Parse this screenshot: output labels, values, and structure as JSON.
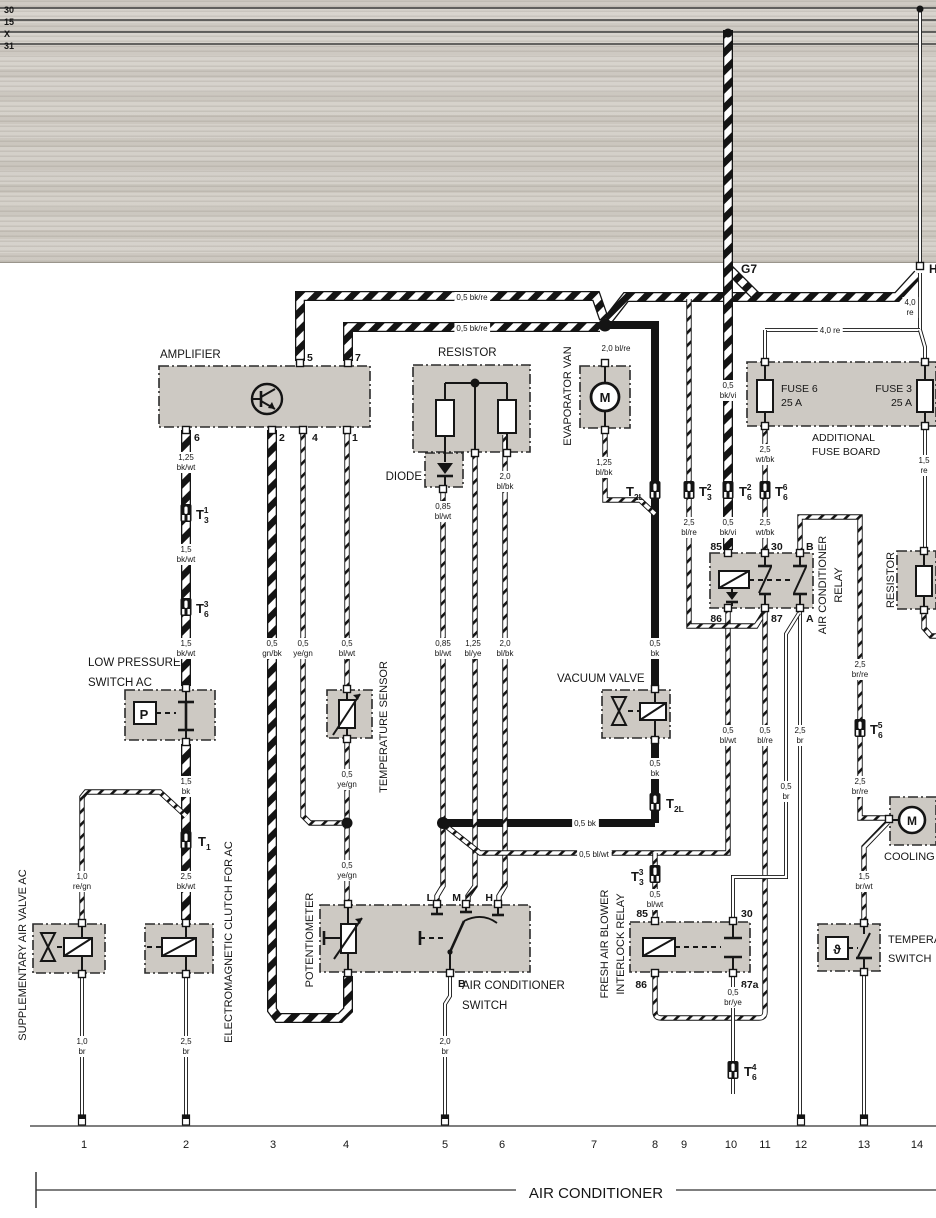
{
  "colors": {
    "ink": "#161616",
    "box_fill": "#cdc9c3",
    "scan_band": "#d6d2cb",
    "paper": "#ffffff"
  },
  "texts": {
    "bus_labels": [
      {
        "name": "bus-label-30",
        "text": "30",
        "x": 4,
        "y": 13,
        "size": 9,
        "bold": true,
        "anchor": "start"
      },
      {
        "name": "bus-label-15",
        "text": "15",
        "x": 4,
        "y": 25,
        "size": 9,
        "bold": true,
        "anchor": "start"
      },
      {
        "name": "bus-label-x",
        "text": "X",
        "x": 4,
        "y": 37,
        "size": 9,
        "bold": true,
        "anchor": "start"
      },
      {
        "name": "bus-label-31",
        "text": "31",
        "x": 4,
        "y": 49,
        "size": 9,
        "bold": true,
        "anchor": "start"
      }
    ],
    "node_labels": [
      {
        "name": "node-g7",
        "text": "G7",
        "x": 741,
        "y": 273,
        "size": 12,
        "bold": true,
        "anchor": "start"
      },
      {
        "name": "node-h",
        "text": "H",
        "x": 929,
        "y": 273,
        "size": 12,
        "bold": true,
        "anchor": "start"
      }
    ],
    "component_labels": [
      {
        "name": "label-amplifier",
        "text": "AMPLIFIER",
        "x": 160,
        "y": 358,
        "size": 11.5,
        "anchor": "start"
      },
      {
        "name": "label-resistor",
        "text": "RESISTOR",
        "x": 438,
        "y": 356,
        "size": 11.5,
        "anchor": "start"
      },
      {
        "name": "label-diode",
        "text": "DIODE",
        "x": 422,
        "y": 480,
        "size": 11.5,
        "anchor": "end"
      },
      {
        "name": "label-evaporator-van",
        "text": "EVAPORATOR VAN",
        "x": 571,
        "y": 396,
        "size": 11,
        "rot": -90
      },
      {
        "name": "label-fuse6",
        "text": "FUSE 6",
        "x": 781,
        "y": 392,
        "size": 10.5,
        "anchor": "start"
      },
      {
        "name": "label-fuse6-amps",
        "text": "25 A",
        "x": 781,
        "y": 406,
        "size": 10.5,
        "anchor": "start"
      },
      {
        "name": "label-fuse3",
        "text": "FUSE 3",
        "x": 912,
        "y": 392,
        "size": 10.5,
        "anchor": "end"
      },
      {
        "name": "label-fuse3-amps",
        "text": "25 A",
        "x": 912,
        "y": 406,
        "size": 10.5,
        "anchor": "end"
      },
      {
        "name": "label-additional",
        "text": "ADDITIONAL",
        "x": 812,
        "y": 441,
        "size": 10.5,
        "anchor": "start"
      },
      {
        "name": "label-fuse-board",
        "text": "FUSE BOARD",
        "x": 812,
        "y": 455,
        "size": 10.5,
        "anchor": "start"
      },
      {
        "name": "label-ac-relay-1",
        "text": "AIR CONDITIONER",
        "x": 826,
        "y": 585,
        "size": 11,
        "rot": -90
      },
      {
        "name": "label-ac-relay-2",
        "text": "RELAY",
        "x": 842,
        "y": 585,
        "size": 11,
        "rot": -90
      },
      {
        "name": "label-resistor-right",
        "text": "RESISTOR",
        "x": 894,
        "y": 580,
        "size": 11,
        "rot": -90
      },
      {
        "name": "label-low-pressure-1",
        "text": "LOW PRESSURE",
        "x": 88,
        "y": 666,
        "size": 11.5,
        "anchor": "start"
      },
      {
        "name": "label-low-pressure-2",
        "text": "SWITCH AC",
        "x": 88,
        "y": 686,
        "size": 11.5,
        "anchor": "start"
      },
      {
        "name": "label-temp-sensor",
        "text": "TEMPERATURE SENSOR",
        "x": 387,
        "y": 727,
        "size": 11,
        "rot": -90
      },
      {
        "name": "label-vacuum-valve",
        "text": "VACUUM VALVE",
        "x": 557,
        "y": 682,
        "size": 11.5,
        "anchor": "start"
      },
      {
        "name": "label-supp-air-valve",
        "text": "SUPPLEMENTARY AIR VALVE AC",
        "x": 26,
        "y": 955,
        "size": 11,
        "rot": -90
      },
      {
        "name": "label-clutch",
        "text": "ELECTROMAGNETIC CLUTCH FOR AC",
        "x": 232,
        "y": 942,
        "size": 11,
        "rot": -90
      },
      {
        "name": "label-potentiometer",
        "text": "POTENTIOMETER",
        "x": 313,
        "y": 940,
        "size": 11,
        "rot": -90
      },
      {
        "name": "label-ac-switch-1",
        "text": "AIR CONDITIONER",
        "x": 462,
        "y": 989,
        "size": 11.5,
        "anchor": "start"
      },
      {
        "name": "label-ac-switch-2",
        "text": "SWITCH",
        "x": 462,
        "y": 1009,
        "size": 11.5,
        "anchor": "start"
      },
      {
        "name": "label-fresh-air-1",
        "text": "FRESH AIR BLOWER",
        "x": 608,
        "y": 944,
        "size": 11,
        "rot": -90
      },
      {
        "name": "label-fresh-air-2",
        "text": "INTERLOCK RELAY",
        "x": 624,
        "y": 944,
        "size": 11,
        "rot": -90
      },
      {
        "name": "label-cooling-fan",
        "text": "COOLING FAN",
        "x": 884,
        "y": 860,
        "size": 11,
        "anchor": "start"
      },
      {
        "name": "label-temp-switch-1",
        "text": "TEMPERATURE",
        "x": 888,
        "y": 943,
        "size": 11,
        "anchor": "start"
      },
      {
        "name": "label-temp-switch-2",
        "text": "SWITCH",
        "x": 888,
        "y": 962,
        "size": 11,
        "anchor": "start"
      }
    ],
    "terminal_labels": [
      {
        "text": "5",
        "x": 307,
        "y": 361,
        "size": 10.5,
        "bold": true,
        "anchor": "start"
      },
      {
        "text": "7",
        "x": 355,
        "y": 361,
        "size": 10.5,
        "bold": true,
        "anchor": "start"
      },
      {
        "text": "6",
        "x": 194,
        "y": 441,
        "size": 10.5,
        "bold": true,
        "anchor": "start"
      },
      {
        "text": "2",
        "x": 279,
        "y": 441,
        "size": 10.5,
        "bold": true,
        "anchor": "start"
      },
      {
        "text": "4",
        "x": 312,
        "y": 441,
        "size": 10.5,
        "bold": true,
        "anchor": "start"
      },
      {
        "text": "1",
        "x": 352,
        "y": 441,
        "size": 10.5,
        "bold": true,
        "anchor": "start"
      },
      {
        "text": "85",
        "x": 722,
        "y": 550,
        "size": 10.5,
        "bold": true,
        "anchor": "end"
      },
      {
        "text": "30",
        "x": 771,
        "y": 550,
        "size": 10.5,
        "bold": true,
        "anchor": "start"
      },
      {
        "text": "B",
        "x": 806,
        "y": 550,
        "size": 10.5,
        "bold": true,
        "anchor": "start"
      },
      {
        "text": "86",
        "x": 722,
        "y": 622,
        "size": 10.5,
        "bold": true,
        "anchor": "end"
      },
      {
        "text": "87",
        "x": 771,
        "y": 622,
        "size": 10.5,
        "bold": true,
        "anchor": "start"
      },
      {
        "text": "A",
        "x": 806,
        "y": 622,
        "size": 10.5,
        "bold": true,
        "anchor": "start"
      },
      {
        "text": "L",
        "x": 433,
        "y": 901,
        "size": 10.5,
        "bold": true,
        "anchor": "end"
      },
      {
        "text": "M",
        "x": 461,
        "y": 901,
        "size": 10.5,
        "bold": true,
        "anchor": "end"
      },
      {
        "text": "H",
        "x": 493,
        "y": 901,
        "size": 10.5,
        "bold": true,
        "anchor": "end"
      },
      {
        "text": "B",
        "x": 458,
        "y": 987,
        "size": 10.5,
        "bold": true,
        "anchor": "start"
      },
      {
        "text": "85",
        "x": 648,
        "y": 917,
        "size": 10.5,
        "bold": true,
        "anchor": "end"
      },
      {
        "text": "30",
        "x": 741,
        "y": 917,
        "size": 10.5,
        "bold": true,
        "anchor": "start"
      },
      {
        "text": "86",
        "x": 647,
        "y": 988,
        "size": 10.5,
        "bold": true,
        "anchor": "end"
      },
      {
        "text": "87a",
        "x": 741,
        "y": 988,
        "size": 10.5,
        "bold": true,
        "anchor": "start"
      }
    ],
    "connector_labels": [
      {
        "name": "conn-t3-1",
        "main": "T",
        "sub": "3",
        "sup": "1",
        "x": 196,
        "y": 519,
        "anchor": "start"
      },
      {
        "name": "conn-t6-3",
        "main": "T",
        "sub": "6",
        "sup": "3",
        "x": 196,
        "y": 613,
        "anchor": "start"
      },
      {
        "name": "conn-t1",
        "main": "T",
        "sub": "1",
        "x": 198,
        "y": 846,
        "anchor": "start"
      },
      {
        "name": "conn-t2l-upper",
        "main": "T",
        "sub": "2L",
        "x": 626,
        "y": 496,
        "anchor": "start"
      },
      {
        "name": "conn-t3-2",
        "main": "T",
        "sub": "3",
        "sup": "2",
        "x": 699,
        "y": 496,
        "anchor": "start"
      },
      {
        "name": "conn-t6-2",
        "main": "T",
        "sub": "6",
        "sup": "2",
        "x": 739,
        "y": 496,
        "anchor": "start"
      },
      {
        "name": "conn-t6-6",
        "main": "T",
        "sub": "6",
        "sup": "6",
        "x": 775,
        "y": 496,
        "anchor": "start"
      },
      {
        "name": "conn-t2l-lower",
        "main": "T",
        "sub": "2L",
        "x": 666,
        "y": 808,
        "anchor": "start"
      },
      {
        "name": "conn-t6-5",
        "main": "T",
        "sub": "6",
        "sup": "5",
        "x": 870,
        "y": 734,
        "anchor": "start"
      },
      {
        "name": "conn-t3-3",
        "main": "T",
        "sub": "3",
        "sup": "3",
        "x": 631,
        "y": 881,
        "anchor": "start"
      },
      {
        "name": "conn-t6-4",
        "main": "T",
        "sub": "6",
        "sup": "4",
        "x": 744,
        "y": 1076,
        "anchor": "start"
      }
    ],
    "wire_labels": [
      {
        "lines": [
          "0,5  bk/re"
        ],
        "x": 472,
        "y": 300,
        "bg": true
      },
      {
        "lines": [
          "0,5  bk/re"
        ],
        "x": 472,
        "y": 331,
        "bg": true
      },
      {
        "lines": [
          "2,0  bl/re"
        ],
        "x": 616,
        "y": 351,
        "bg": true
      },
      {
        "lines": [
          "4,0",
          "re"
        ],
        "x": 910,
        "y": 305,
        "bg": true
      },
      {
        "lines": [
          "4,0  re"
        ],
        "x": 830,
        "y": 333,
        "bg": true
      },
      {
        "lines": [
          "1,25",
          "bl/bk"
        ],
        "x": 604,
        "y": 465,
        "bg": true
      },
      {
        "lines": [
          "0,85",
          "bl/wt"
        ],
        "x": 443,
        "y": 509,
        "bg": true
      },
      {
        "lines": [
          "2,0",
          "bl/bk"
        ],
        "x": 505,
        "y": 479,
        "bg": true
      },
      {
        "lines": [
          "1,25",
          "bk/wt"
        ],
        "x": 186,
        "y": 460,
        "bg": true
      },
      {
        "lines": [
          "1,5",
          "bk/wt"
        ],
        "x": 186,
        "y": 552,
        "bg": true
      },
      {
        "lines": [
          "1,5",
          "bk/wt"
        ],
        "x": 186,
        "y": 646,
        "bg": true
      },
      {
        "lines": [
          "0,5",
          "gn/bk"
        ],
        "x": 272,
        "y": 646,
        "bg": true
      },
      {
        "lines": [
          "0,5",
          "ye/gn"
        ],
        "x": 303,
        "y": 646,
        "bg": true
      },
      {
        "lines": [
          "0,5",
          "bl/wt"
        ],
        "x": 347,
        "y": 646,
        "bg": true
      },
      {
        "lines": [
          "0,85",
          "bl/wt"
        ],
        "x": 443,
        "y": 646,
        "bg": true
      },
      {
        "lines": [
          "1,25",
          "bl/ye"
        ],
        "x": 473,
        "y": 646,
        "bg": true
      },
      {
        "lines": [
          "2,0",
          "bl/bk"
        ],
        "x": 505,
        "y": 646,
        "bg": true
      },
      {
        "lines": [
          "0,5",
          "bk"
        ],
        "x": 655,
        "y": 646,
        "bg": true
      },
      {
        "lines": [
          "0,5",
          "ye/gn"
        ],
        "x": 347,
        "y": 777,
        "bg": true
      },
      {
        "lines": [
          "1,5",
          "bk"
        ],
        "x": 186,
        "y": 784,
        "bg": true
      },
      {
        "lines": [
          "0,5",
          "bk"
        ],
        "x": 655,
        "y": 766,
        "bg": true
      },
      {
        "lines": [
          "1,0",
          "re/gn"
        ],
        "x": 82,
        "y": 879,
        "bg": true
      },
      {
        "lines": [
          "2,5",
          "bk/wt"
        ],
        "x": 186,
        "y": 879,
        "bg": true
      },
      {
        "lines": [
          "0,5",
          "ye/gn"
        ],
        "x": 347,
        "y": 868,
        "bg": true
      },
      {
        "lines": [
          "0,5 bk"
        ],
        "x": 585,
        "y": 826,
        "bg": true
      },
      {
        "lines": [
          "0,5 bl/wt"
        ],
        "x": 594,
        "y": 857,
        "bg": true
      },
      {
        "lines": [
          "0,5",
          "bl/wt"
        ],
        "x": 655,
        "y": 897,
        "bg": true
      },
      {
        "lines": [
          "0,5",
          "bk/vi"
        ],
        "x": 728,
        "y": 388,
        "bg": true
      },
      {
        "lines": [
          "2,5",
          "wt/bk"
        ],
        "x": 765,
        "y": 452,
        "bg": true
      },
      {
        "lines": [
          "0,5",
          "bk/vi"
        ],
        "x": 728,
        "y": 525,
        "bg": true
      },
      {
        "lines": [
          "2,5",
          "wt/bk"
        ],
        "x": 765,
        "y": 525,
        "bg": true
      },
      {
        "lines": [
          "2,5",
          "bl/re"
        ],
        "x": 689,
        "y": 525,
        "bg": true
      },
      {
        "lines": [
          "1,5",
          "re"
        ],
        "x": 924,
        "y": 463,
        "bg": true
      },
      {
        "lines": [
          "0,5",
          "bl/wt"
        ],
        "x": 728,
        "y": 733,
        "bg": true
      },
      {
        "lines": [
          "0,5",
          "bl/re"
        ],
        "x": 765,
        "y": 733,
        "bg": true
      },
      {
        "lines": [
          "2,5",
          "br"
        ],
        "x": 800,
        "y": 733,
        "bg": true
      },
      {
        "lines": [
          "0,5",
          "br"
        ],
        "x": 786,
        "y": 789,
        "bg": true
      },
      {
        "lines": [
          "2,5",
          "br/re"
        ],
        "x": 860,
        "y": 667,
        "bg": true
      },
      {
        "lines": [
          "2,5",
          "br/re"
        ],
        "x": 860,
        "y": 784,
        "bg": true
      },
      {
        "lines": [
          "1,5",
          "br/wt"
        ],
        "x": 864,
        "y": 879,
        "bg": true
      },
      {
        "lines": [
          "0,5",
          "br/ye"
        ],
        "x": 733,
        "y": 995,
        "bg": true
      },
      {
        "lines": [
          "1,0",
          "br"
        ],
        "x": 82,
        "y": 1044,
        "bg": true
      },
      {
        "lines": [
          "2,5",
          "br"
        ],
        "x": 186,
        "y": 1044,
        "bg": true
      },
      {
        "lines": [
          "2,0",
          "br"
        ],
        "x": 445,
        "y": 1044,
        "bg": true
      }
    ],
    "glyphs": [
      {
        "name": "amplifier-transistor",
        "text": "",
        "x": 267,
        "y": 399,
        "size": 1
      },
      {
        "name": "lp-switch-p",
        "text": "P",
        "x": 144,
        "y": 719,
        "size": 13,
        "bold": true
      },
      {
        "name": "temp-switch-theta",
        "text": "ϑ",
        "x": 837,
        "y": 954,
        "size": 13,
        "bold": true
      },
      {
        "name": "evap-motor-m",
        "text": "M",
        "x": 605,
        "y": 402,
        "size": 13,
        "bold": true
      },
      {
        "name": "fan-motor-m",
        "text": "M",
        "x": 912,
        "y": 825,
        "size": 12,
        "bold": true
      }
    ],
    "track_numbers": [
      {
        "text": "1",
        "x": 84,
        "y": 1148,
        "size": 11
      },
      {
        "text": "2",
        "x": 186,
        "y": 1148,
        "size": 11
      },
      {
        "text": "3",
        "x": 273,
        "y": 1148,
        "size": 11
      },
      {
        "text": "4",
        "x": 346,
        "y": 1148,
        "size": 11
      },
      {
        "text": "5",
        "x": 445,
        "y": 1148,
        "size": 11
      },
      {
        "text": "6",
        "x": 502,
        "y": 1148,
        "size": 11
      },
      {
        "text": "7",
        "x": 594,
        "y": 1148,
        "size": 11
      },
      {
        "text": "8",
        "x": 655,
        "y": 1148,
        "size": 11
      },
      {
        "text": "9",
        "x": 684,
        "y": 1148,
        "size": 11
      },
      {
        "text": "10",
        "x": 731,
        "y": 1148,
        "size": 11
      },
      {
        "text": "11",
        "x": 765,
        "y": 1148,
        "size": 11
      },
      {
        "text": "12",
        "x": 801,
        "y": 1148,
        "size": 11
      },
      {
        "text": "13",
        "x": 864,
        "y": 1148,
        "size": 11
      },
      {
        "text": "14",
        "x": 917,
        "y": 1148,
        "size": 11
      }
    ],
    "footer": [
      {
        "name": "footer-title",
        "text": "AIR CONDITIONER",
        "x": 596,
        "y": 1198,
        "size": 15
      }
    ]
  }
}
